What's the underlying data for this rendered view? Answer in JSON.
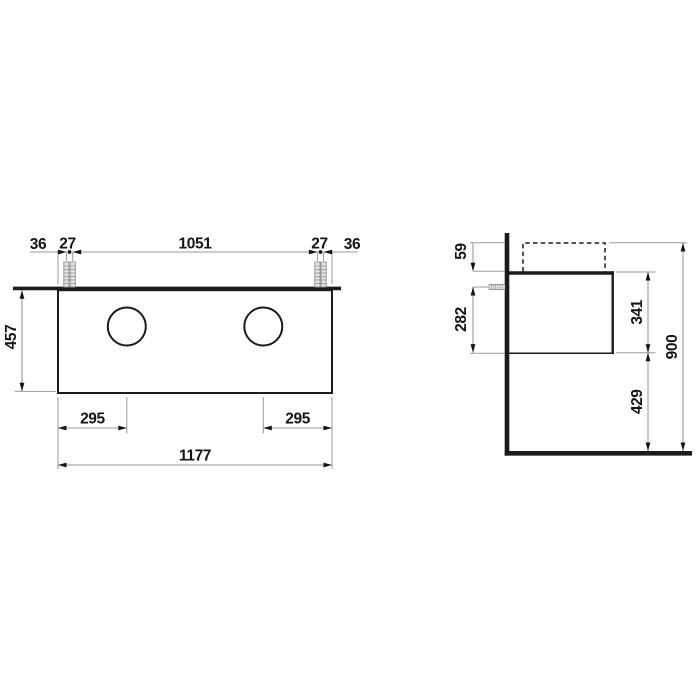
{
  "colors": {
    "bg": "#ffffff",
    "obj": "#1b1b1b",
    "dim": "#141414",
    "guide": "#9a9a9a"
  },
  "front_view": {
    "edge_to_bolt_left_mm": "36",
    "bolt_pair_gap_left_mm": "27",
    "bolt_to_bolt_span_mm": "1051",
    "bolt_pair_gap_right_mm": "27",
    "edge_to_bolt_right_mm": "36",
    "overall_height_mm": "457",
    "left_basin_center_from_edge_mm": "295",
    "right_basin_center_from_edge_mm": "295",
    "overall_width_mm": "1177"
  },
  "side_view": {
    "top_edge_to_anchor_mm": "59",
    "anchor_to_bottom_edge_mm": "282",
    "cabinet_height_mm": "341",
    "top_edge_height_from_floor_mm": "900",
    "floor_clearance_mm": "429"
  }
}
